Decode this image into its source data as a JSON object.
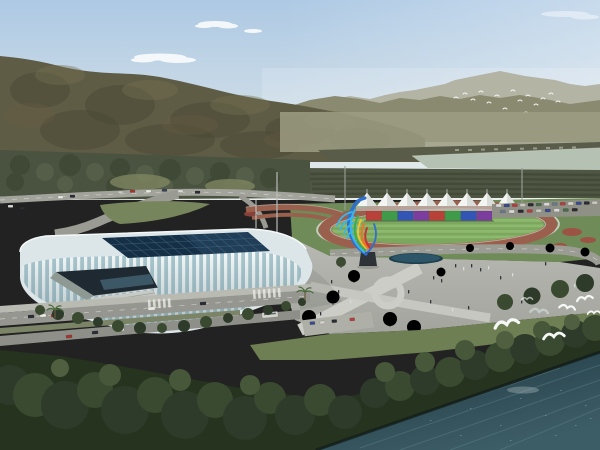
{
  "scene": {
    "description": "Aerial architectural rendering of a riverside sports complex: white ribbed gymnasium with dark glass skylight roof, outdoor running track with white canopy grandstand and rainbow banner wall, colorful ribbon sculpture on a plaza, tree-lined roads with cars, forested mountains behind, a river band in the distance and dark teal water with white egrets in the foreground",
    "sky": {
      "top_color": "#adc9e4",
      "horizon_color": "#e6ebe8",
      "cloud_color": "#ffffff",
      "cloud_count": 4
    },
    "mountains": {
      "far_ridge_color": "#a6a694",
      "mid_ridge_color": "#8a8a70",
      "main_color": "#5f5c46",
      "valley_haze_color": "#9c9c82"
    },
    "river": {
      "color": "#b5c1b2",
      "far_bank_color": "#585c49"
    },
    "fields": {
      "orchard_color": "#505644",
      "left_forest_color": "#4a5240"
    },
    "birds": {
      "distant_flock_count": 15,
      "gull_count": 7,
      "color": "#f5f8f5"
    },
    "sports_park": {
      "lawn_color": "#6f8c58",
      "track": {
        "lane_color": "#9a5f4d",
        "edge_line_color": "#d8d8d0",
        "infield_color": "#7ba75e",
        "infield_stripe_color": "#99c478"
      },
      "grandstand_tents": {
        "count": 8,
        "color": "#f3f5f2"
      },
      "banner_wall": {
        "panel_count": 8,
        "colors": [
          "#b8423a",
          "#3f9b4a",
          "#3356b5",
          "#7b3d9e"
        ]
      },
      "warmup_path_color": "#99604e",
      "flower_bed_color": "#a34a40",
      "parking_car_colors": [
        "#d8d8d8",
        "#3a4a8a",
        "#b04040",
        "#c8c8c0",
        "#2a2a30",
        "#4a6a4a",
        "#6a7a8a"
      ]
    },
    "sculpture": {
      "ribbon_colors": [
        "#2e6fd0",
        "#39b7e8",
        "#3fae4e",
        "#f2c12e",
        "#e8762a",
        "#c83232"
      ],
      "base_color": "#2e3338"
    },
    "stadium": {
      "shell_color": "#dce6e9",
      "facade_glass_color": "#a9c6ce",
      "rib_color": "#f4f8f8",
      "roof_glass_color": "#152f46",
      "roof_grid_color": "#4a7088",
      "entrance_color": "#1f2931",
      "stair_color": "#c6cac5"
    },
    "plaza": {
      "pavement_color": "#b0b2ab",
      "path_color": "#cccdc6",
      "pool_color": "#20404f",
      "pool_water_color": "#2c5668",
      "people_count": 24,
      "tree_color": "#3c4a33"
    },
    "roads": {
      "asphalt_color": "#95968f",
      "sidewalk_color": "#b9bab2",
      "median_color": "#7c8468",
      "marking_color": "#e8e8e2",
      "car_colors": [
        "#2a2e34",
        "#e8e8e4",
        "#a03830",
        "#d8d8d0"
      ]
    },
    "shore": {
      "lawn_color": "#6d7f53",
      "tree_dark": "#26331f",
      "tree_mid": "#2e3b2a",
      "tree_light": "#47573a"
    },
    "water": {
      "far_color": "#1f3842",
      "near_color": "#3d5d66",
      "streak_color": "#72969e"
    }
  }
}
